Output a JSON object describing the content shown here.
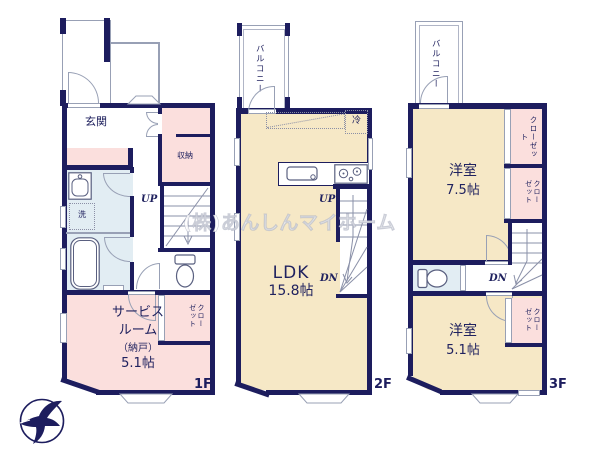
{
  "watermark": "(株)あんしんマイホーム",
  "colors": {
    "wall": "#1d1d5e",
    "room_cream": "#f6e8c6",
    "room_pink": "#fbdfdd",
    "wet_area_blue": "#e2edf3",
    "line_gray": "#98a0b5"
  },
  "floors": {
    "f1": {
      "label": "1F",
      "entrance": "玄関",
      "storage": "収納",
      "laundry": "洗",
      "up": "UP",
      "closet": "クローゼット",
      "service_room_name_1": "サービス",
      "service_room_name_2": "ルーム",
      "service_room_note": "（納戸）",
      "service_room_size": "5.1帖"
    },
    "f2": {
      "label": "2F",
      "balcony": "バルコニー",
      "refrigerator": "冷",
      "up": "UP",
      "down": "DN",
      "ldk_name": "LDK",
      "ldk_size": "15.8帖"
    },
    "f3": {
      "label": "3F",
      "balcony": "バルコニー",
      "room_a_name": "洋室",
      "room_a_size": "7.5帖",
      "closet_a": "クローゼット",
      "closet_b": "クローゼット",
      "down": "DN",
      "room_b_name": "洋室",
      "room_b_size": "5.1帖",
      "closet_c": "クローゼット"
    }
  }
}
